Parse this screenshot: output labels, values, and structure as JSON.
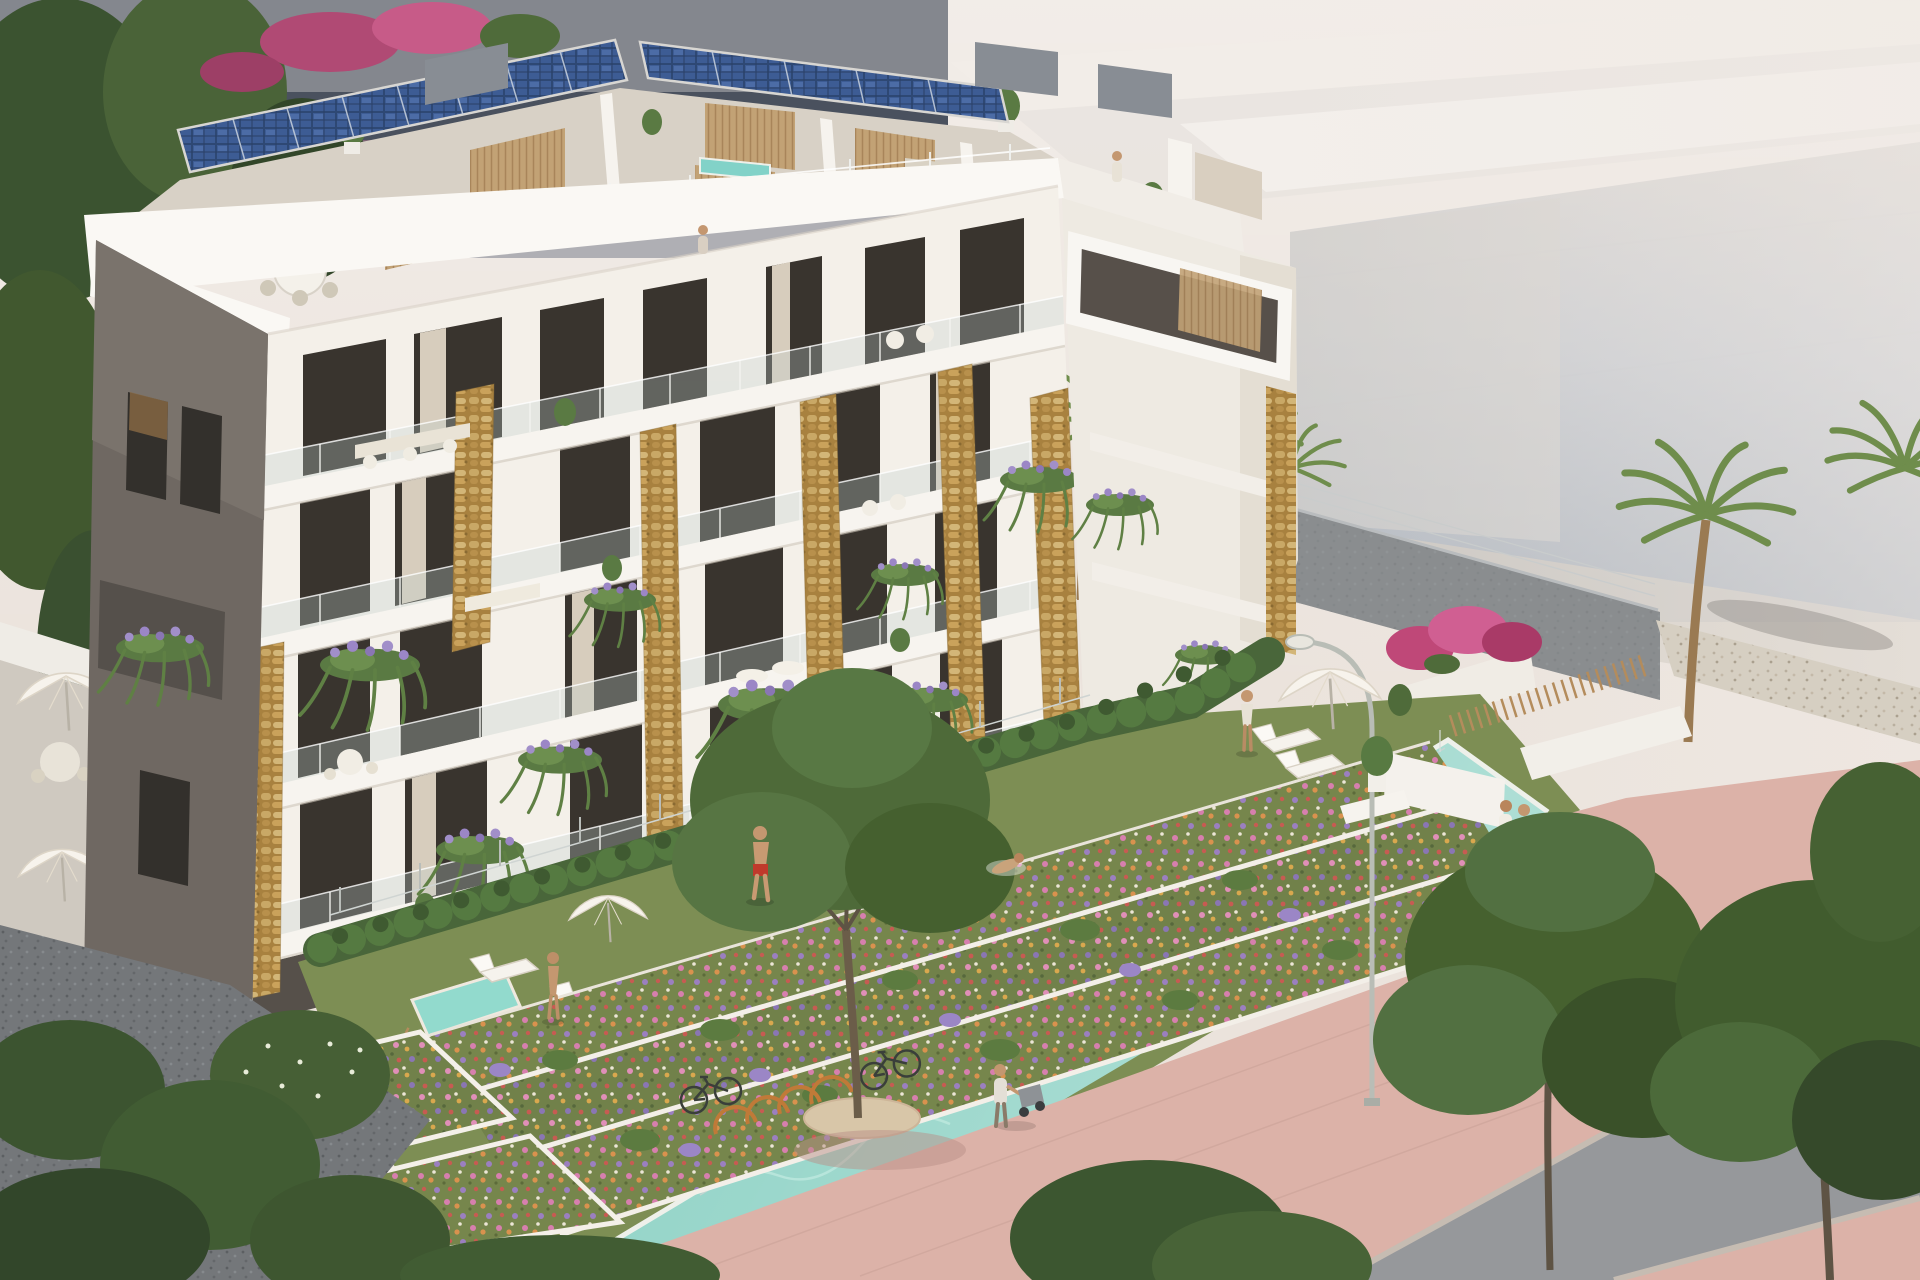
{
  "meta": {
    "title": "Aerial architectural rendering of a modern apartment residence",
    "view": "elevated three-quarter aerial view, hazy coastal daylight",
    "visible_text": "none"
  },
  "palette": {
    "backdrop": "#ebe3dc",
    "bg_building_grey": "#84878e",
    "bg_building_band": "#4a515e",
    "bg_building_mauve": "#7b6374",
    "bg_building_lower": "#a7a9ae",
    "street_light": "#f2ede8",
    "fog_face_light": "#d6d2cd",
    "building_white": "#f4f0e9",
    "fascia_white": "#faf8f4",
    "slab_white": "#f7f4ef",
    "gable_dark": "#6f6862",
    "gable_right": "#eeeae2",
    "stone_base": "#a8813f",
    "window_glass": "#39342e",
    "curtain": "#d7cdbd",
    "wood_slat": "#c2a275",
    "solar_panel": "#2e4874",
    "hot_tub_water": "#82d2c8",
    "glass_rail": "#c2d2d0",
    "hedge_green": "#49663a",
    "lawn_green": "#7d8e54",
    "pool_water": "#8ed2c5",
    "pool_coping": "#eef0ea",
    "plunge_pool": "#92dacd",
    "flower_bed_green": "#76864c",
    "flower_pink": "#d77fae",
    "flower_orange": "#d9924e",
    "flower_purple": "#9b7fc0",
    "lavender": "#a18fc9",
    "bougainvillea": "#bf4878",
    "plaza_paving": "#dcb2a8",
    "road_asphalt": "#96989b",
    "gravel_light": "#d6cfc2",
    "gravel_dark": "#74777a",
    "tree_dark": "#3b5330",
    "tree_mid": "#4a6638",
    "palm_frond": "#6f8d4c",
    "palm_trunk": "#9a7a52",
    "umbrella_white": "#f7f3ec",
    "furniture_white": "#f6f3ed",
    "skin_tone": "#c49770",
    "swim_shorts_red": "#c0392b",
    "bike_rack_orange": "#c07a38",
    "bike_frame": "#3a3f3a",
    "lamp_grey": "#b9bdb6",
    "trunk_brown": "#5e5344"
  },
  "scene": {
    "building": {
      "floors_visible": 5,
      "features": [
        "rooftop solar panel array",
        "rooftop terraces with wood-clad hot tubs",
        "wood slat privacy walls",
        "white parapet and fascia bands",
        "glass balustrade balconies",
        "natural stone clad pillars",
        "planters with lavender and trailing ferns",
        "floor-to-ceiling glazing with curtains",
        "dark taupe side gable wall",
        "white penthouse picture-frame balcony"
      ]
    },
    "amenities": [
      "long communal swimming pool",
      "lawn sunbathing area",
      "private plunge pool terrace",
      "white sun loungers",
      "white parasols",
      "curved street lamp",
      "terraced flower beds",
      "pink paved promenade",
      "bicycle racks with bicycles",
      "palm trees",
      "bougainvillea shrubs"
    ],
    "people": [
      "man in red swim shorts walking on lawn",
      "woman standing at plunge pool terrace",
      "woman standing on pool lawn",
      "swimmer in the pool",
      "couple strolling on promenade",
      "person pushing a stroller",
      "person on penthouse terrace",
      "person on rooftop lounge terrace"
    ],
    "environment": [
      "grey apartment block top left",
      "hazy pale building volumes right",
      "sunlit streets behind",
      "green street trees in foreground",
      "gravel strips",
      "asphalt road crossing the promenade"
    ]
  }
}
